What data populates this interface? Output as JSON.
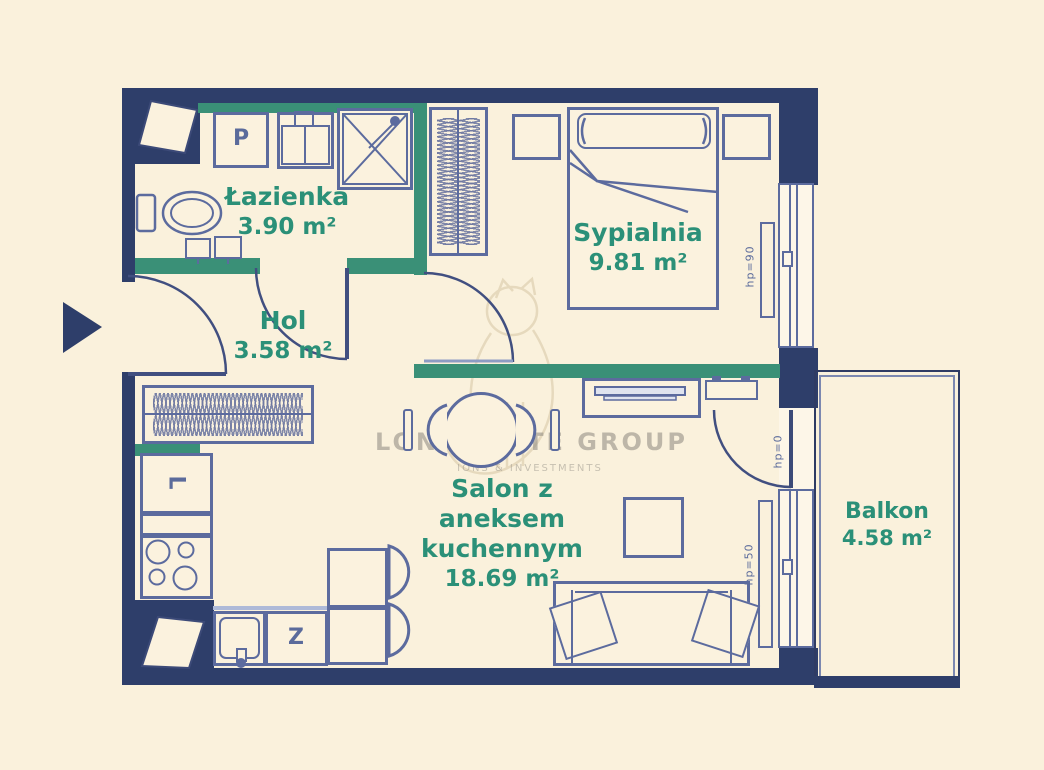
{
  "rooms": {
    "lazienka": {
      "name": "Łazienka",
      "area": "3.90 m²"
    },
    "sypialnia": {
      "name": "Sypialnia",
      "area": "9.81 m²"
    },
    "hol": {
      "name": "Hol",
      "area": "3.58 m²"
    },
    "salon": {
      "lines": [
        "Salon z",
        "aneksem",
        "kuchennym"
      ],
      "area": "18.69 m²"
    },
    "balkon": {
      "name": "Balkon",
      "area": "4.58 m²"
    }
  },
  "appliances": {
    "washer": "P",
    "fridge": "L",
    "dishwasher": "Z"
  },
  "openings": {
    "bedroom_window": "hp=90",
    "balcony_door": "hp=0",
    "living_window": "hp=50"
  },
  "watermark": {
    "line1": "LON ESTATE GROUP",
    "line2": "IONS & INVESTMENTS"
  },
  "colors": {
    "background": "#faf1dc",
    "wall_navy": "#2e3e6a",
    "wall_teal": "#3a9077",
    "furniture_stroke": "#5c6b9e",
    "label_teal": "#2b9078"
  }
}
